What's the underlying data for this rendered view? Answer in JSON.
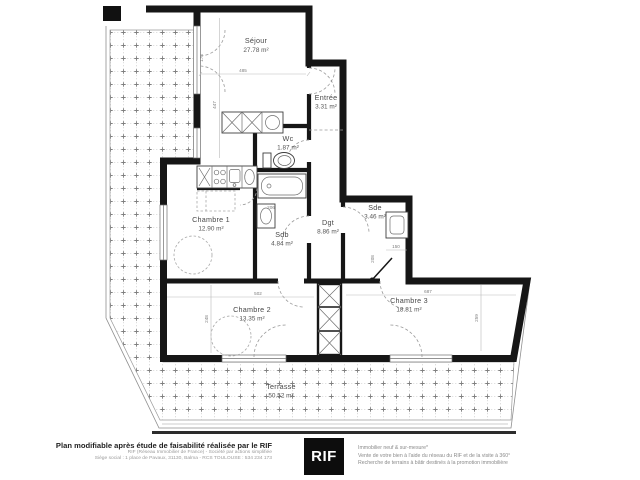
{
  "plan": {
    "rooms": [
      {
        "name": "Séjour",
        "area": "27.78 m²"
      },
      {
        "name": "Entrée",
        "area": "3.31 m²"
      },
      {
        "name": "Wc",
        "area": "1.87 m²"
      },
      {
        "name": "Chambre 1",
        "area": "12.90 m²"
      },
      {
        "name": "Sdb",
        "area": "4.84 m²"
      },
      {
        "name": "Dgt",
        "area": "8.86 m²"
      },
      {
        "name": "Sde",
        "area": "3.46 m²"
      },
      {
        "name": "Chambre 2",
        "area": "13.35 m²"
      },
      {
        "name": "Chambre 3",
        "area": "18.81 m²"
      },
      {
        "name": "Terrasse",
        "area": "50.52 m²"
      }
    ],
    "dimensions": {
      "sejour_width": "485",
      "sejour_height": "447",
      "sejour_door": "178",
      "chambre2_width": "502",
      "chambre2_height": "248",
      "chambre3_width": "687",
      "chambre3_height": "259",
      "sdb_detail": "206",
      "sde_width": "150",
      "sde_height": "208"
    }
  },
  "footer": {
    "left": {
      "headline": "Plan modifiable après étude de faisabilité réalisée par le RIF",
      "line2": "RIF (Réseau Immobilier de France) - Société par actions simplifiée",
      "line3": "Siège social : 1 place de Pavaux, 31130, Balma - RCS TOULOUSE : 534 234 173"
    },
    "logo_text": "RIF",
    "right": {
      "line1": "Immobilier neuf & sur-mesure*",
      "line2": "Vente de votre bien à l'aide du réseau du RIF et de la visite à 360°",
      "line3": "Recherche de terrains à bâtir destinés à la promotion immobilière"
    }
  },
  "colors": {
    "wall": "#161616",
    "thin_line": "#8f8f8f",
    "hatch": "#b5b5b5",
    "label": "#474747"
  }
}
